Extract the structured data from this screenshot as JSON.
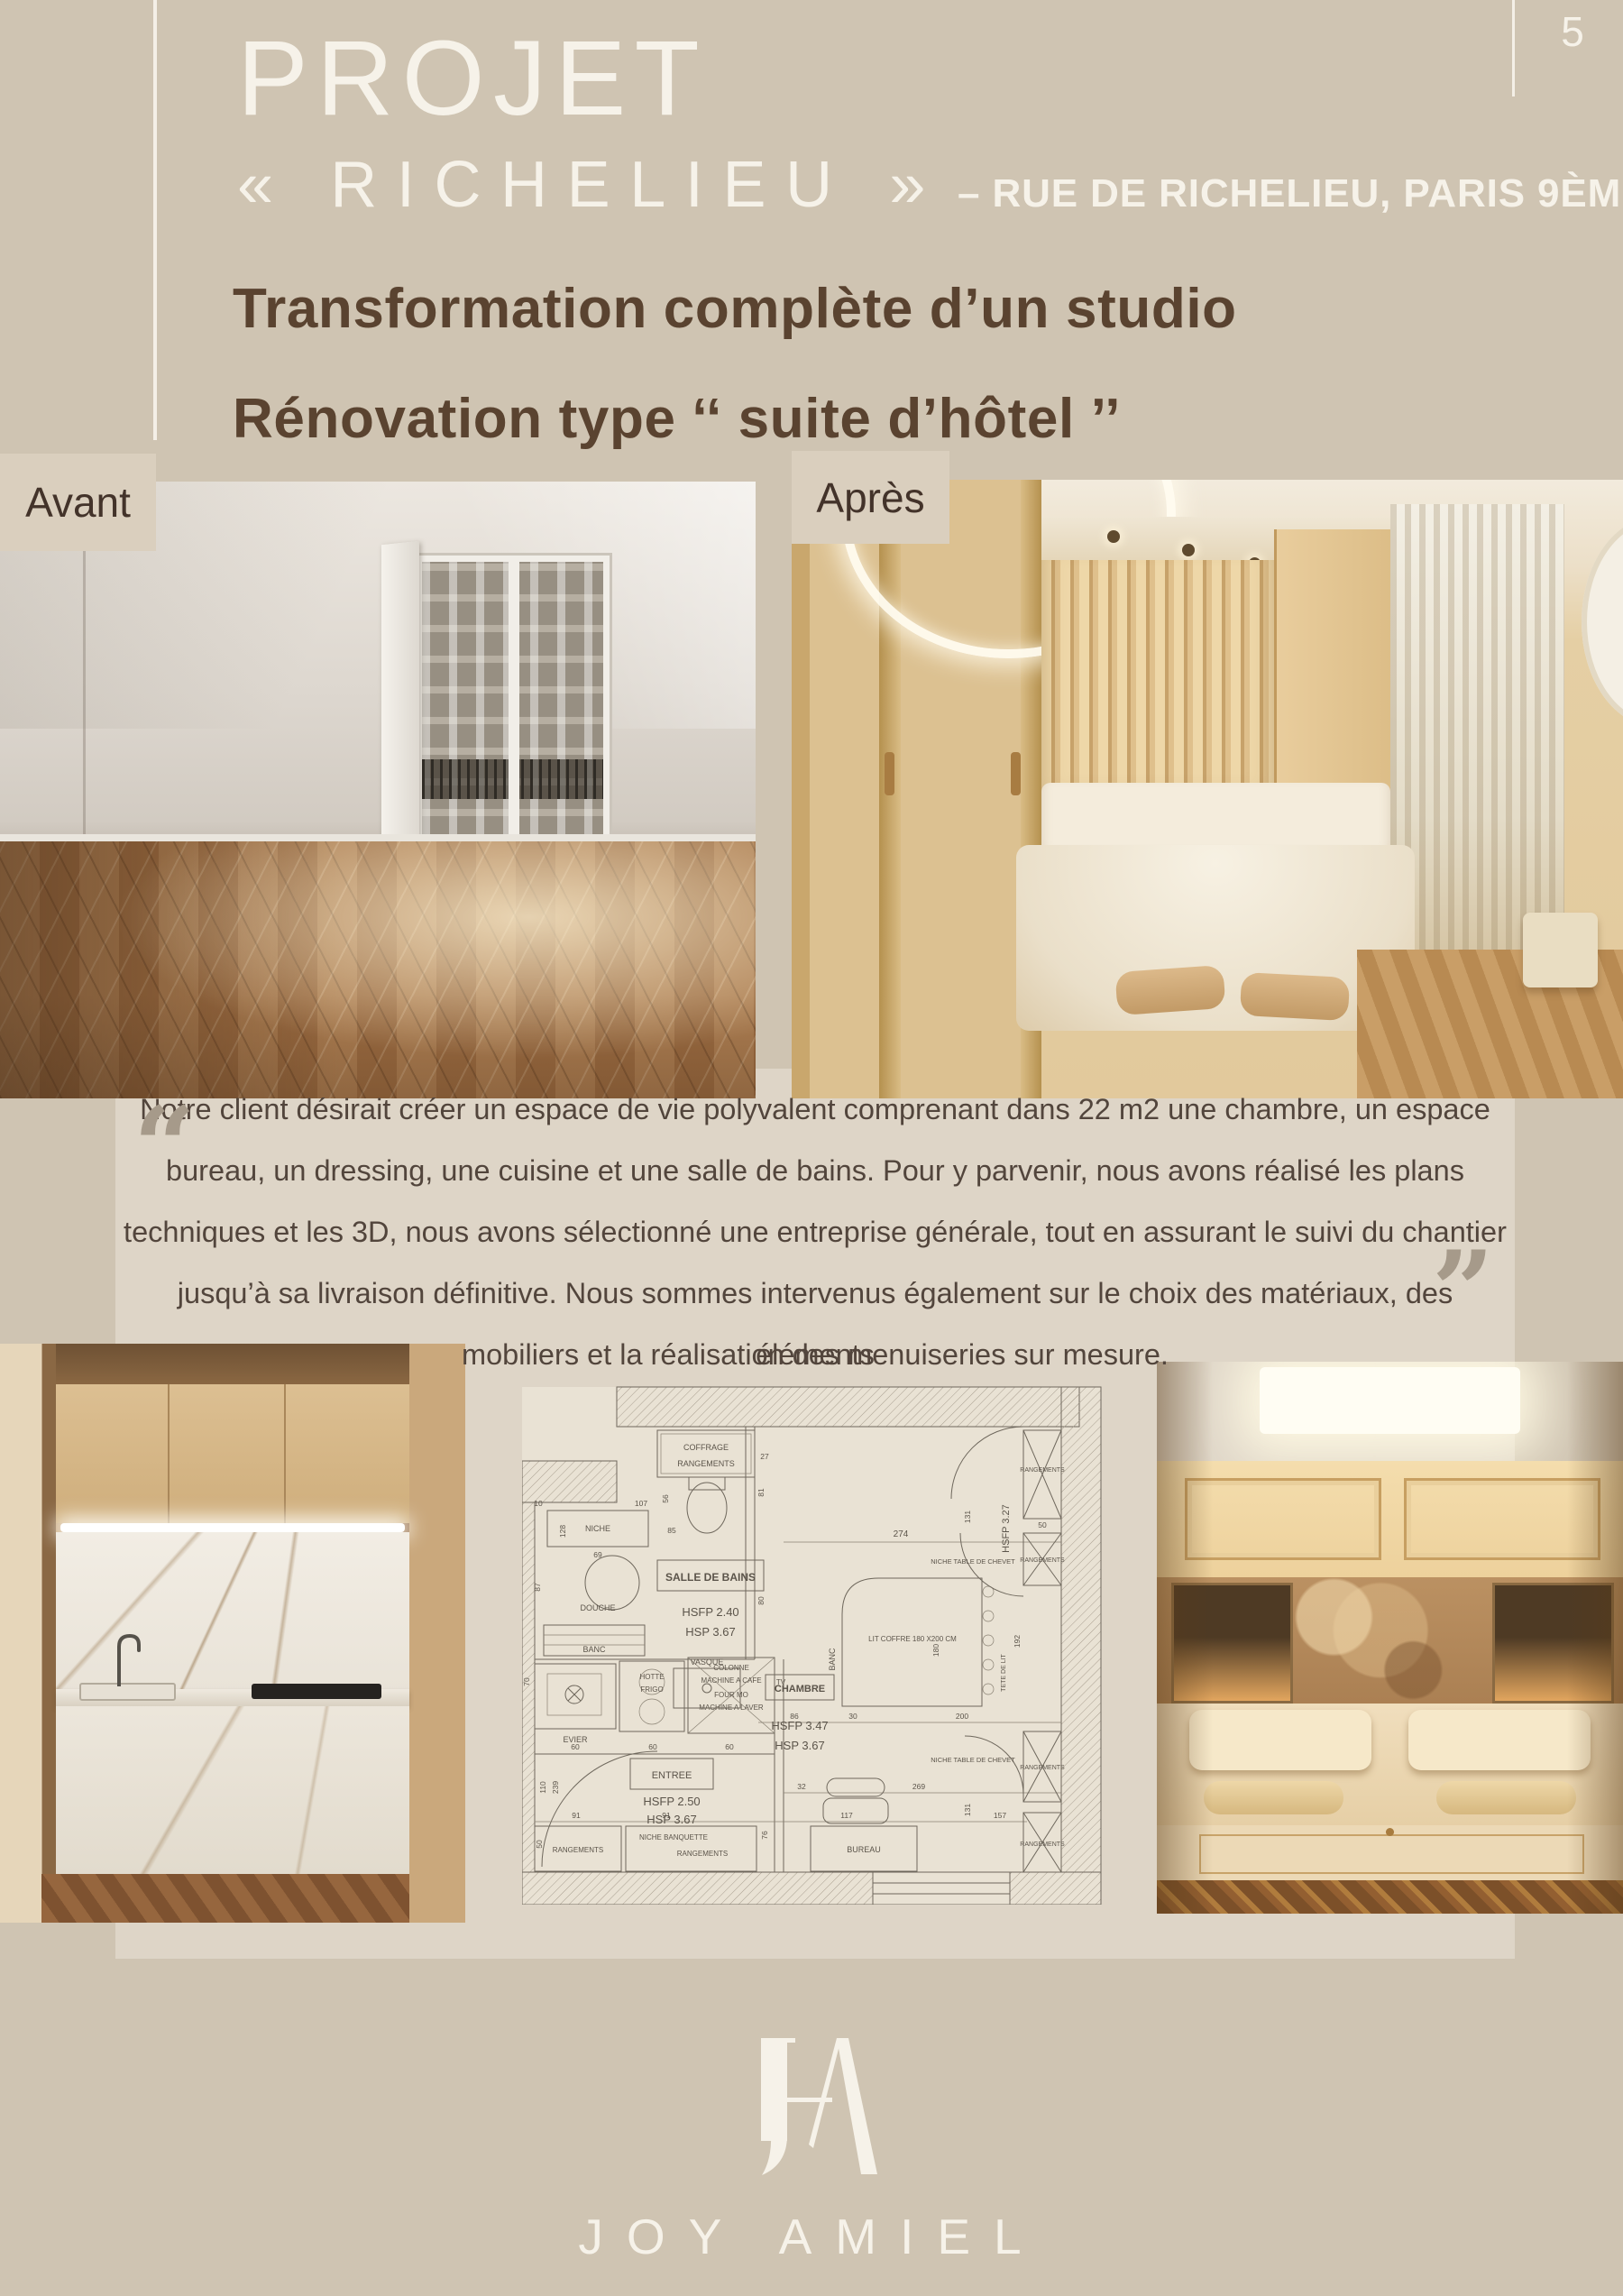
{
  "page": {
    "number": "5"
  },
  "header": {
    "title": "PROJET",
    "project_name": "« RICHELIEU »",
    "address": "– RUE DE RICHELIEU, PARIS 9ÈME"
  },
  "headline": {
    "line1": "Transformation complète d’un studio",
    "line2": "Rénovation type ‘‘ suite d’hôtel ’’"
  },
  "before_after": {
    "before_label": "Avant",
    "after_label": "Après"
  },
  "quote": {
    "open_mark": "“",
    "close_mark": "”",
    "lines": [
      "Notre client désirait créer un espace de vie polyvalent comprenant dans 22 m2 une chambre, un espace",
      "bureau, un dressing, une cuisine et une salle de bains. Pour y parvenir, nous avons réalisé les plans",
      "techniques et les 3D, nous avons sélectionné une entreprise générale, tout en assurant le suivi du chantier",
      "jusqu’à sa livraison définitive. Nous sommes intervenus également sur le choix des matériaux, des éléments",
      "mobiliers et la réalisation des menuiseries sur mesure."
    ]
  },
  "plan": {
    "labels": [
      "COFFRAGE",
      "RANGEMENTS",
      "NICHE",
      "DOUCHE",
      "BANC",
      "SALLE DE BAINS",
      "HSFP  2.40",
      "HSP  3.67",
      "VASQUE",
      "EVIER",
      "HOTTE",
      "FRIGO",
      "COLONNE",
      "MACHINE A CAFE",
      "FOUR MO",
      "MACHINE A LAVER",
      "TV",
      "ENTREE",
      "HSFP  2.50",
      "HSP  3.67",
      "RANGEMENTS",
      "NICHE BANQUETTE",
      "RANGEMENTS",
      "BUREAU",
      "CHAMBRE",
      "HSFP  3.47",
      "HSP  3.67",
      "LIT COFFRE 180 X200 CM",
      "BANC",
      "HSFP 3.27",
      "TETE DE LIT",
      "RANGEMENTS",
      "RANGEMENTS",
      "NICHE TABLE DE CHEVET",
      "RANGEMENTS",
      "RANGEMENTS",
      "NICHE TABLE DE CHEVET"
    ],
    "dims": [
      "69",
      "87",
      "128",
      "107",
      "10",
      "56",
      "85",
      "27",
      "81",
      "80",
      "274",
      "131",
      "50",
      "86",
      "30",
      "200",
      "60",
      "60",
      "60",
      "70",
      "110",
      "239",
      "91",
      "91",
      "117",
      "269",
      "157",
      "131",
      "180",
      "192",
      "32",
      "76",
      "50"
    ]
  },
  "footer": {
    "monogram": "JA",
    "brand": "JOY AMIEL"
  }
}
